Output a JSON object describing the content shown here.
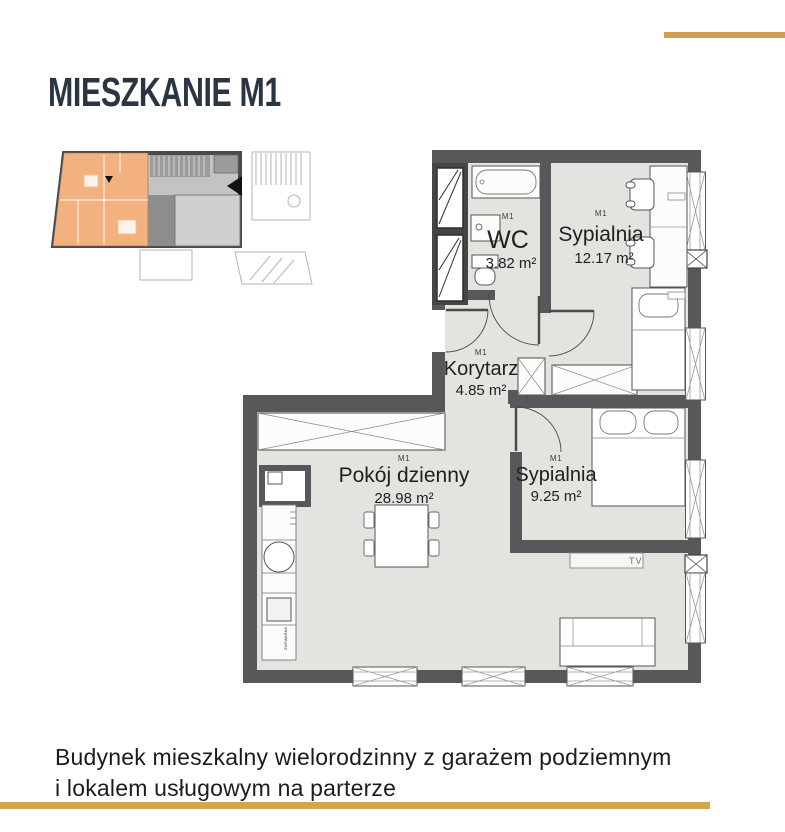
{
  "page": {
    "title": "MIESZKANIE M1"
  },
  "caption": {
    "line1": "Budynek mieszkalny wielorodzinny z garażem podziemnym",
    "line2": "i lokalem usługowym na parterze"
  },
  "floorplan": {
    "rooms": {
      "wc": {
        "unit": "M1",
        "name": "WC",
        "area": "3.82 m²"
      },
      "bedroom1": {
        "unit": "M1",
        "name": "Sypialnia",
        "area": "12.17 m²"
      },
      "corridor": {
        "unit": "M1",
        "name": "Korytarz",
        "area": "4.85 m²"
      },
      "living": {
        "unit": "M1",
        "name": "Pokój dzienny",
        "area": "28.98 m²"
      },
      "bedroom2": {
        "unit": "M1",
        "name": "Sypialnia",
        "area": "9.25 m²"
      }
    },
    "tv_label": "TV",
    "kitchen_appliance_label": "ZMYWARKA"
  },
  "colors": {
    "accent_gold": "#D49C4E",
    "title_navy": "#2B3542",
    "wall_gray": "#58585A",
    "floor_gray": "#E4E3E0",
    "minimap_highlight_orange": "#F2B17E"
  }
}
